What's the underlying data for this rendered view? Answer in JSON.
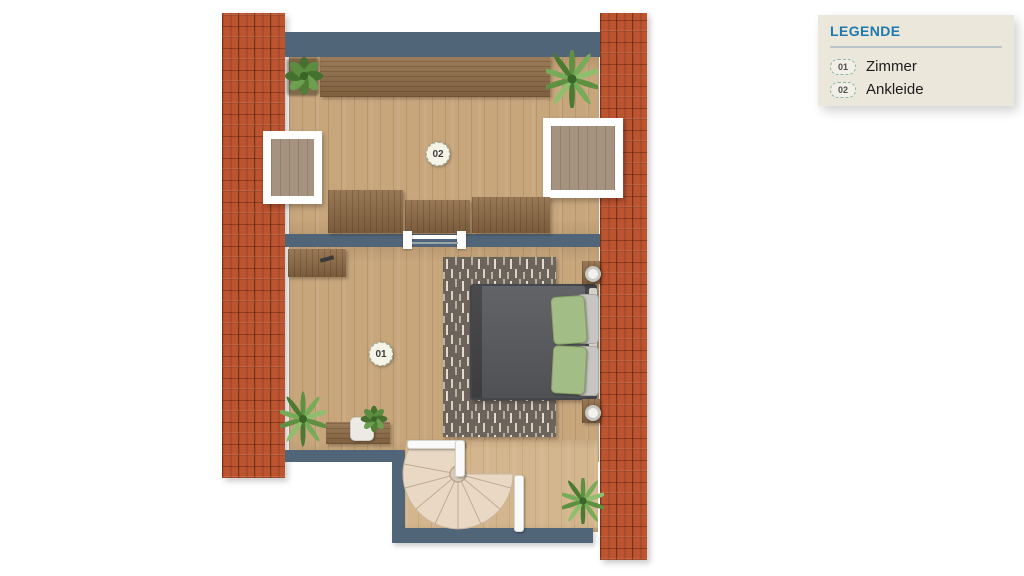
{
  "legend": {
    "title": "LEGENDE",
    "items": [
      {
        "code": "01",
        "label": "Zimmer"
      },
      {
        "code": "02",
        "label": "Ankleide"
      }
    ]
  },
  "plan": {
    "type": "floorplan-top-view",
    "rooms": [
      {
        "code": "01",
        "name": "Zimmer"
      },
      {
        "code": "02",
        "name": "Ankleide"
      }
    ],
    "features": [
      "roof-tile-strips",
      "skylight-left",
      "skylight-right",
      "double-bed",
      "rug",
      "spiral-staircase",
      "wardrobes",
      "desks",
      "plants",
      "door-between-rooms"
    ]
  },
  "colors": {
    "wall": "#516579",
    "roof_tile": "#bc5430",
    "floor": "#c7a67c",
    "dark_wood": "#8f6c47",
    "rug": "#6c635b",
    "bed": "#595a5e",
    "pillow_green": "#a3bd86",
    "stair": "#e8d8c4",
    "legend_bg": "#ebe7da",
    "legend_title": "#1d79af"
  }
}
